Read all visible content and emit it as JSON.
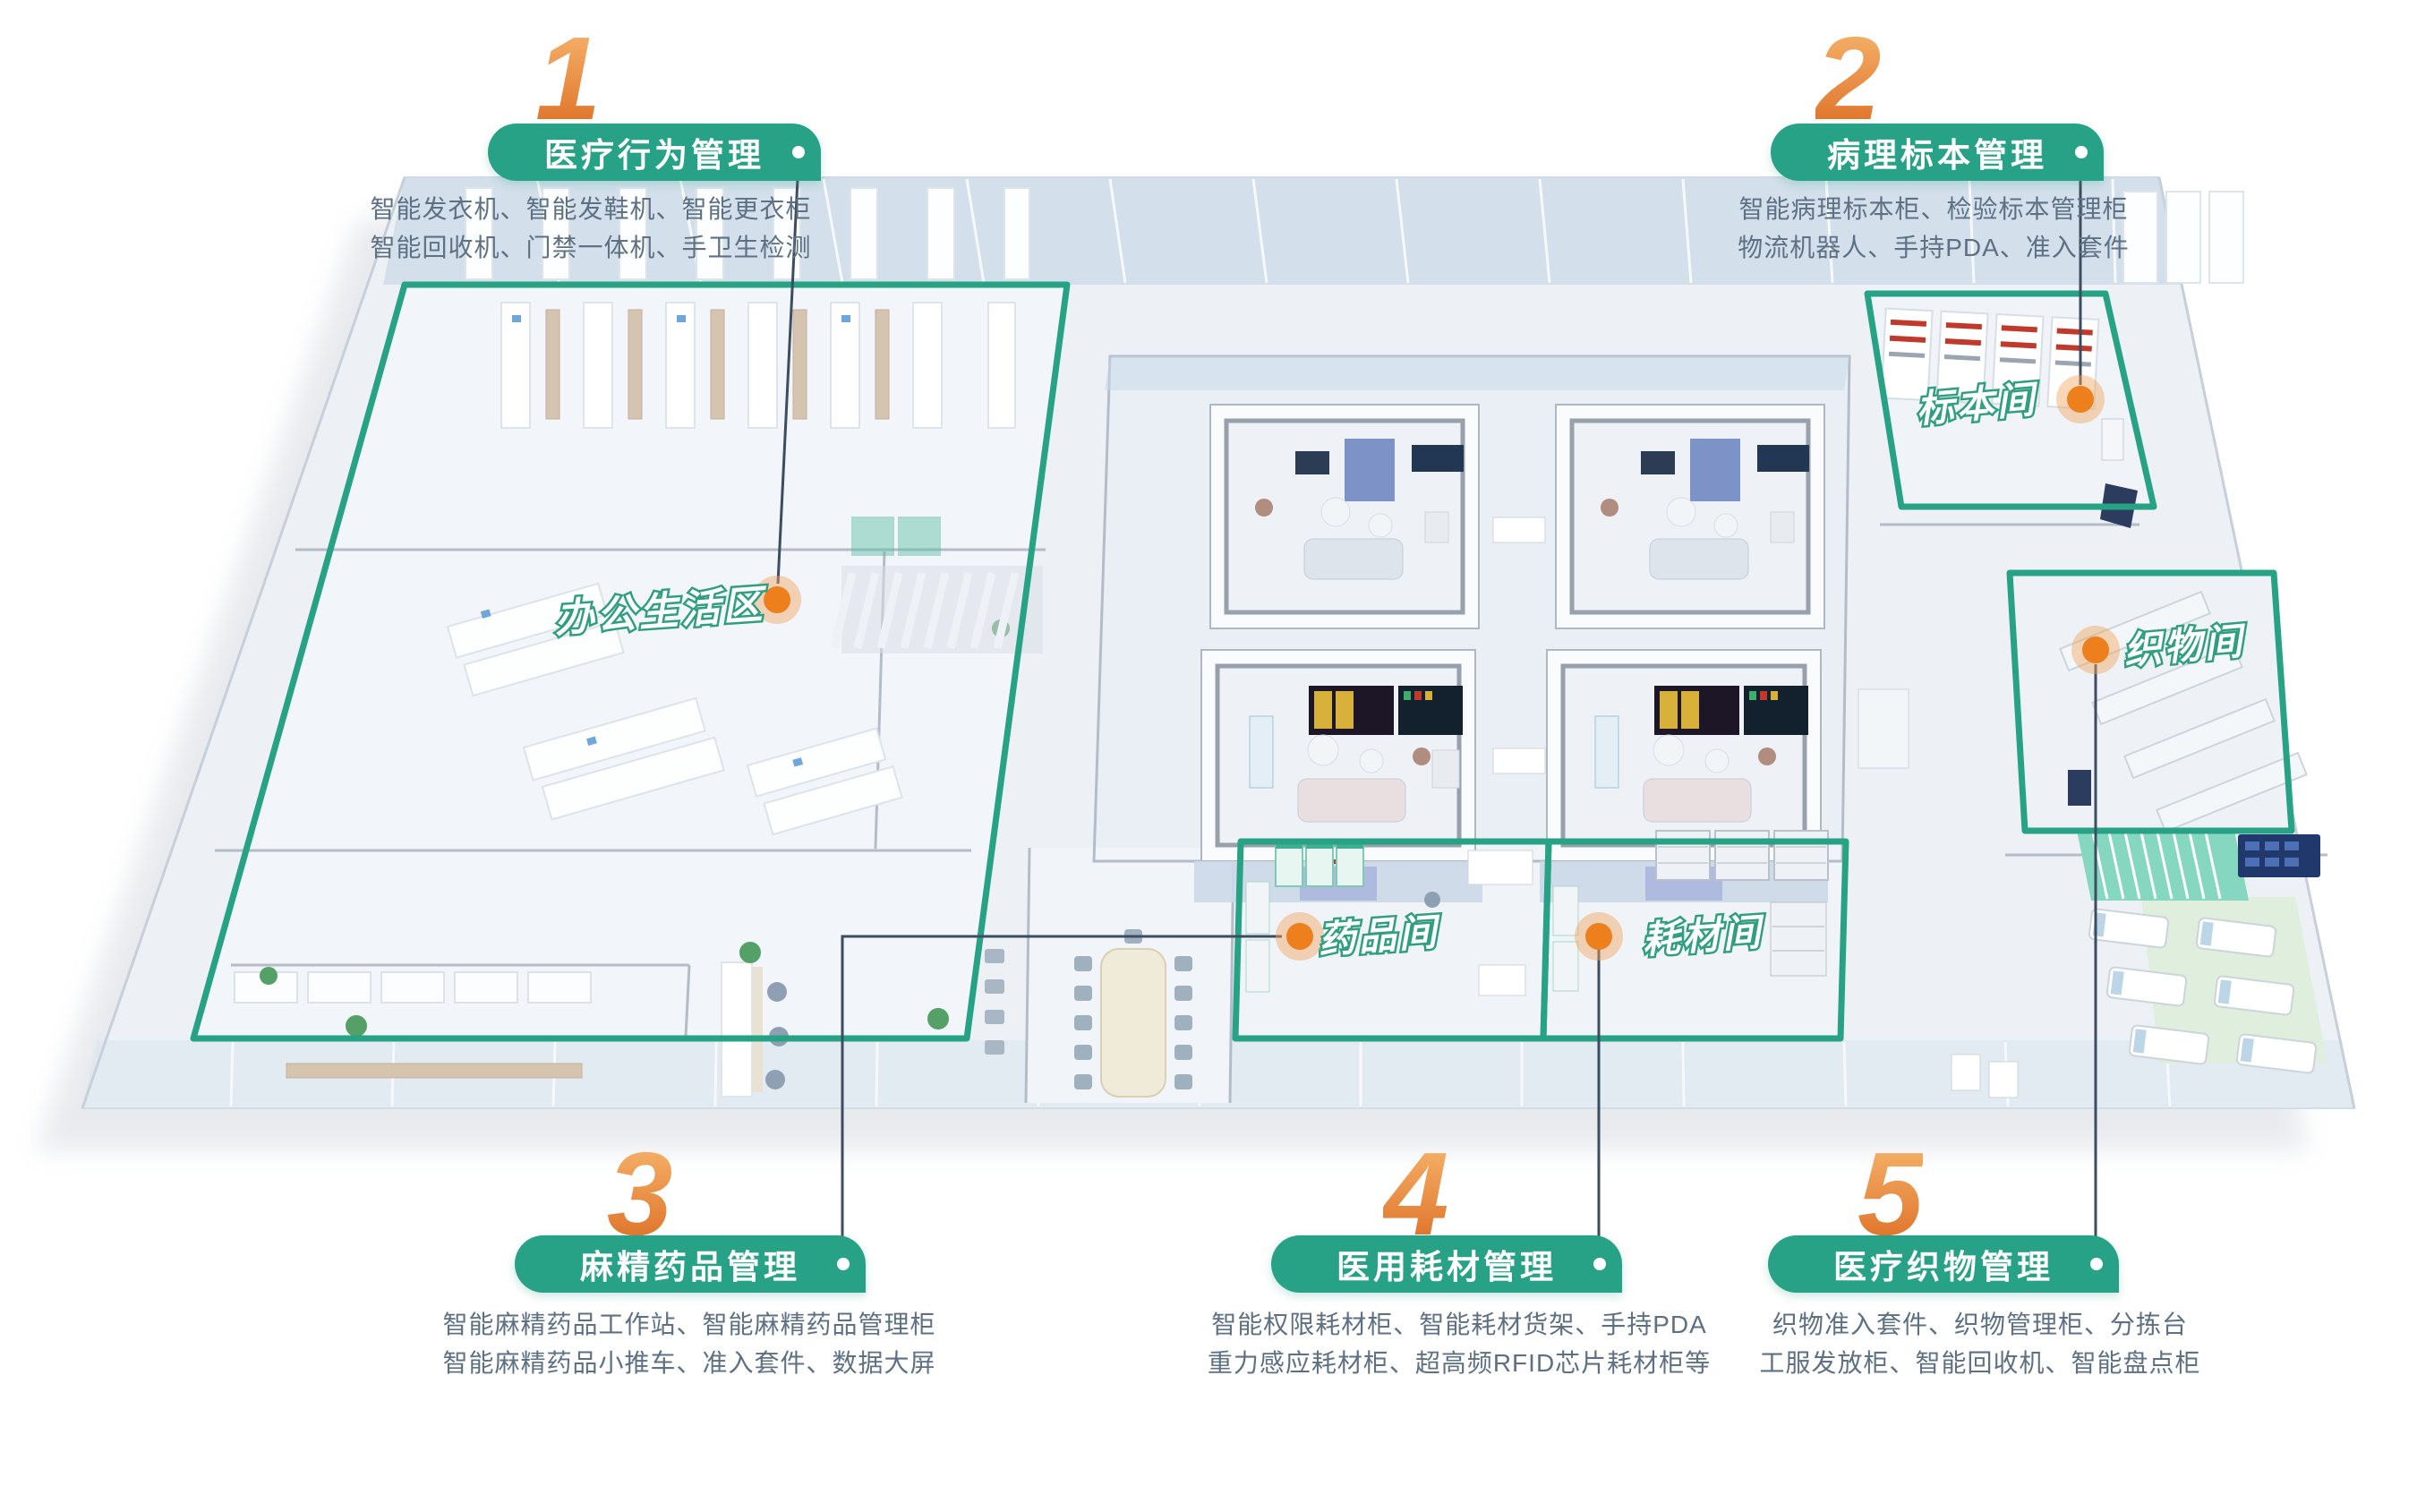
{
  "colors": {
    "accent_green": "#28a287",
    "accent_orange": "#ee7f1d",
    "number_gradient_top": "#f5b169",
    "number_gradient_bottom": "#df7229",
    "leader_line": "#3c4d61",
    "description_text": "#5d7084"
  },
  "sections": [
    {
      "number": "1",
      "title": "医疗行为管理",
      "desc_line1": "智能发衣机、智能发鞋机、智能更衣柜",
      "desc_line2": "智能回收机、门禁一体机、手卫生检测"
    },
    {
      "number": "2",
      "title": "病理标本管理",
      "desc_line1": "智能病理标本柜、检验标本管理柜",
      "desc_line2": "物流机器人、手持PDA、准入套件"
    },
    {
      "number": "3",
      "title": "麻精药品管理",
      "desc_line1": "智能麻精药品工作站、智能麻精药品管理柜",
      "desc_line2": "智能麻精药品小推车、准入套件、数据大屏"
    },
    {
      "number": "4",
      "title": "医用耗材管理",
      "desc_line1": "智能权限耗材柜、智能耗材货架、手持PDA",
      "desc_line2": "重力感应耗材柜、超高频RFID芯片耗材柜等"
    },
    {
      "number": "5",
      "title": "医疗织物管理",
      "desc_line1": "织物准入套件、织物管理柜、分拣台",
      "desc_line2": "工服发放柜、智能回收机、智能盘点柜"
    }
  ],
  "rooms": [
    {
      "id": "office",
      "label": "办公生活区"
    },
    {
      "id": "specimen",
      "label": "标本间"
    },
    {
      "id": "fabric",
      "label": "织物间"
    },
    {
      "id": "drug",
      "label": "药品间"
    },
    {
      "id": "consumable",
      "label": "耗材间"
    }
  ]
}
